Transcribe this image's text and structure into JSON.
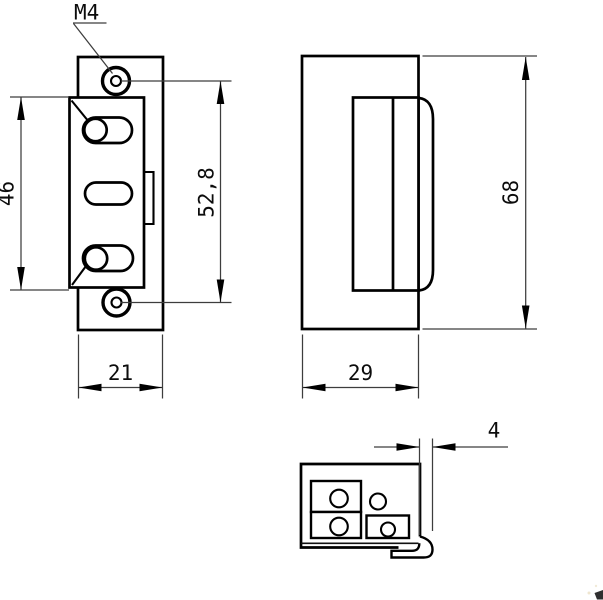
{
  "drawing": {
    "background": "#ffffff",
    "line_color": "#000000",
    "dimension_line_color": "#3d3d3d",
    "labels": {
      "thread_callout": "M4",
      "front_cutout_height": "46",
      "front_screw_spacing": "52,8",
      "front_width": "21",
      "side_height": "68",
      "side_depth": "29",
      "lip_offset": "4"
    }
  }
}
